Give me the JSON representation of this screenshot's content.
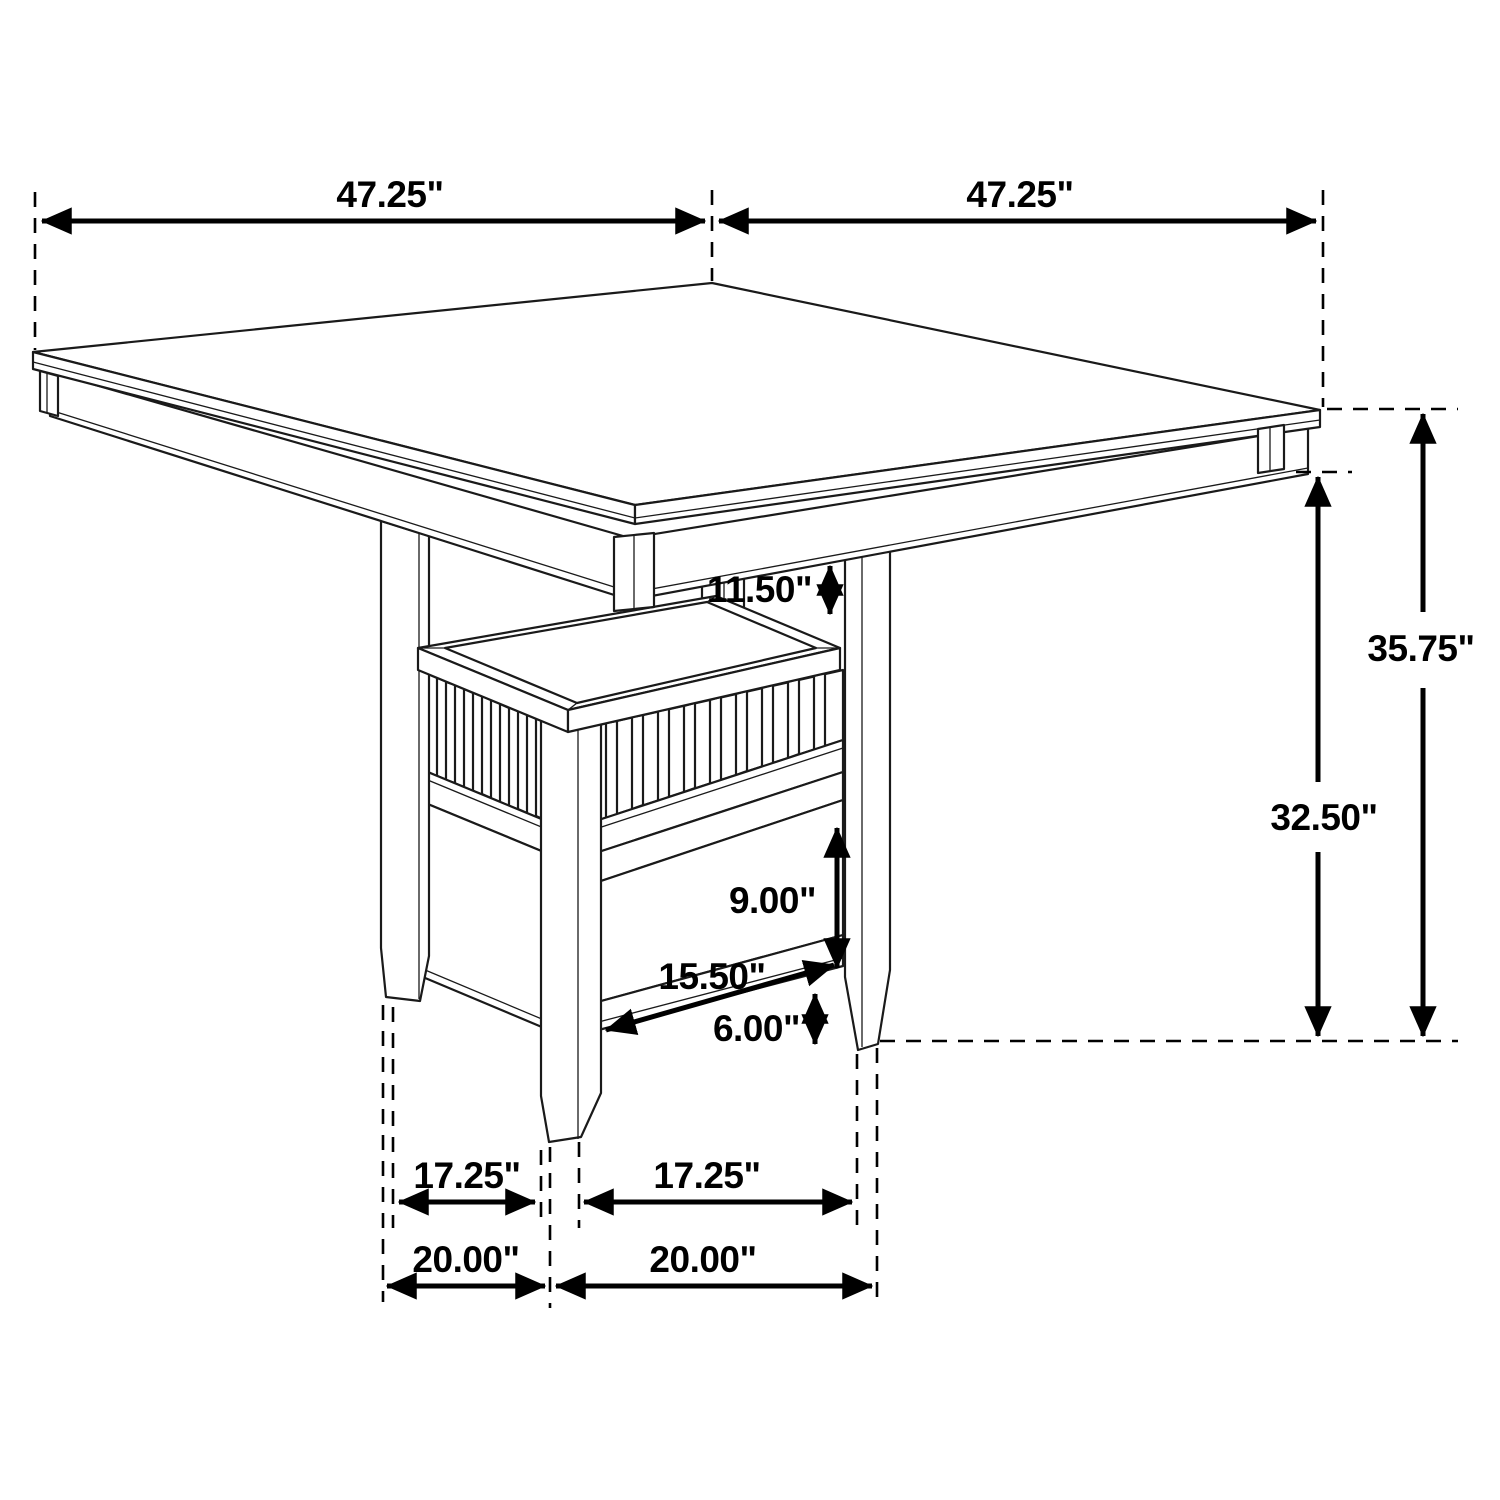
{
  "diagram": {
    "background": "#ffffff",
    "line_color": "#1a1a1a",
    "dimension_color": "#000000",
    "labels": {
      "top_width_left": "47.25\"",
      "top_width_right": "47.25\"",
      "overall_height": "35.75\"",
      "apron_height_to_floor": "32.50\"",
      "top_to_basket_gap": "11.50\"",
      "drawer_section_height": "9.00\"",
      "base_bottom_width": "15.50\"",
      "floor_clearance": "6.00\"",
      "feet_span_inner_left": "17.25\"",
      "feet_span_inner_right": "17.25\"",
      "feet_span_outer_left": "20.00\"",
      "feet_span_outer_right": "20.00\""
    }
  }
}
